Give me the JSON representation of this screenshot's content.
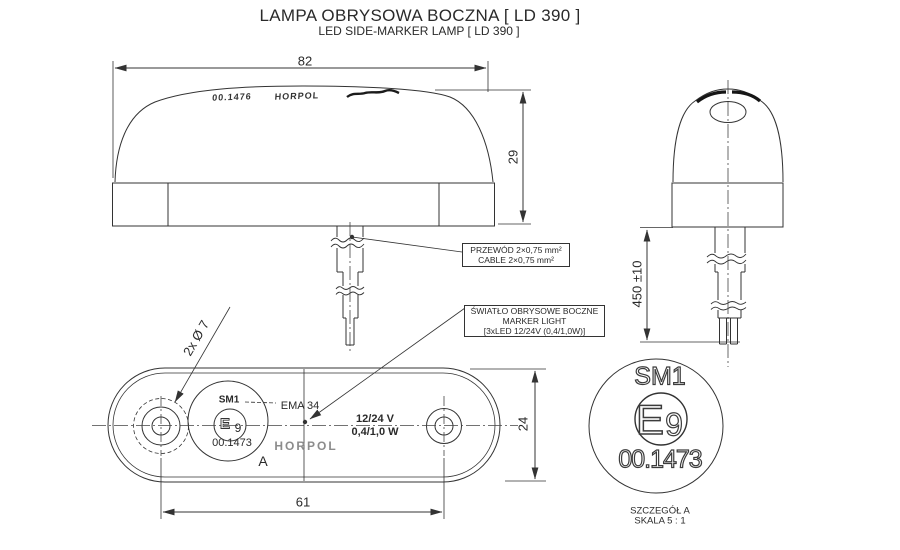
{
  "title": {
    "line1_pl": "LAMPA OBRYSOWA BOCZNA [ LD 390 ]",
    "line2_en": "LED SIDE-MARKER LAMP [ LD 390 ]"
  },
  "side_view": {
    "dim_width": "82",
    "dim_height": "29",
    "mold_code": "00.1476",
    "mold_brand": "HORPOL",
    "cable_callout": {
      "line1": "PRZEWÓD 2×0,75 mm²",
      "line2": "CABLE 2×0,75 mm²"
    }
  },
  "front_view": {
    "dim_cable_length": "450 ±10"
  },
  "bottom_view": {
    "dim_holes": "2x Ø 7",
    "dim_hole_spacing": "61",
    "dim_body_width": "24",
    "marker_callout": {
      "line1": "ŚWIATŁO OBRYSOWE BOCZNE",
      "line2": "MARKER LIGHT",
      "line3": "[3xLED 12/24V (0,4/1,0W)]"
    },
    "approval": {
      "model": "SM1",
      "e_letter": "E",
      "e_number": "9",
      "code": "00.1473"
    },
    "ema_code": "EMA 34",
    "voltage": "12/24 V",
    "power": "0,4/1,0 W",
    "brand": "HORPOL",
    "detail_ref": "A"
  },
  "detail_a": {
    "model": "SM1",
    "e_letter": "E",
    "e_number": "9",
    "code": "00.1473",
    "caption_line1": "SZCZEGÓŁ A",
    "caption_line2": "SKALA 5 : 1"
  },
  "colors": {
    "line": "#333333",
    "text": "#2a2a2a",
    "molded_text": "#8c8c8c",
    "background": "#ffffff"
  }
}
